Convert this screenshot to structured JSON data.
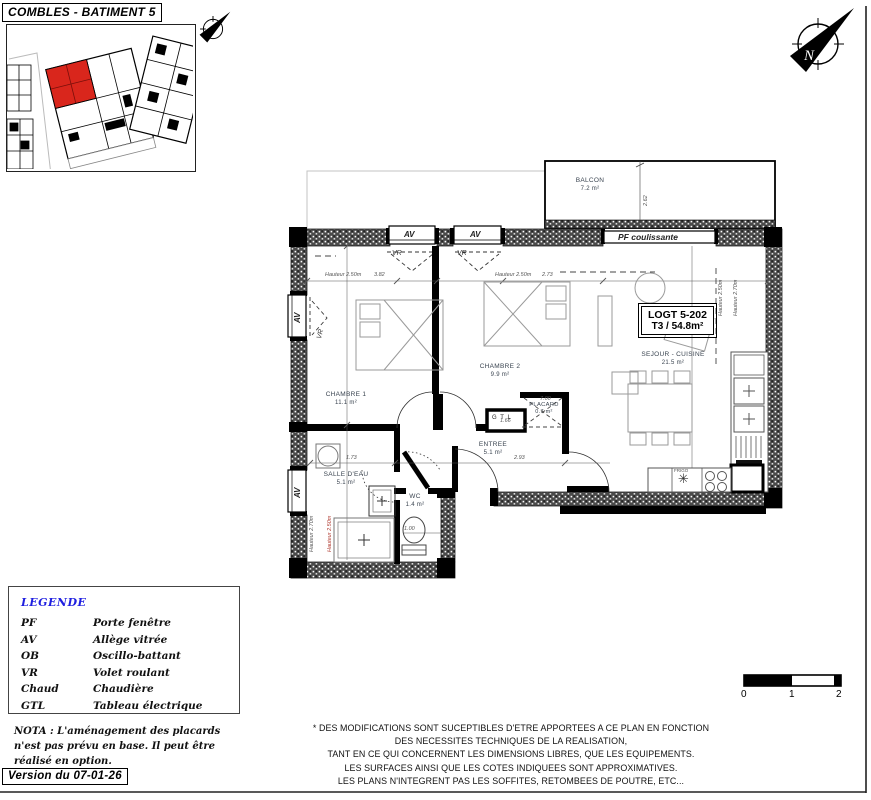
{
  "title": "COMBLES - BATIMENT 5",
  "version_label": "Version du 07-01-26",
  "apartment": {
    "id": "LOGT 5-202",
    "type": "T3 / 54.8m²"
  },
  "rooms": [
    {
      "name": "BALCON",
      "area": "7.2 m²"
    },
    {
      "name": "CHAMBRE 1",
      "area": "11.1 m²"
    },
    {
      "name": "CHAMBRE 2",
      "area": "9.9 m²"
    },
    {
      "name": "SEJOUR - CUISINE",
      "area": "21.5 m²"
    },
    {
      "name": "ENTREE",
      "area": "5.1 m²"
    },
    {
      "name": "SALLE D'EAU",
      "area": "5.1 m²"
    },
    {
      "name": "WC",
      "area": "1.4 m²"
    },
    {
      "name": "PLACARD",
      "area": "0.7 m²"
    }
  ],
  "plan_annotations": {
    "pf_coulissante": "PF coulissante",
    "av": "AV",
    "vr": "VR",
    "gtl": "G T L",
    "frigo": "FRIGO"
  },
  "dims": [
    "Hauteur 2.50m",
    "3.82",
    "Hauteur 2.50m",
    "2.73",
    "1.73",
    "2.93",
    "1.66",
    "7.00",
    "1.00",
    "Hauteur 2.70m",
    "Hauteur 2.50m",
    "Hauteur 2.50m",
    "Hauteur 2.70m",
    "2.62"
  ],
  "legend": {
    "title": "LEGENDE",
    "items": [
      {
        "abbr": "PF",
        "label": "Porte fenêtre"
      },
      {
        "abbr": "AV",
        "label": "Allège vitrée"
      },
      {
        "abbr": "OB",
        "label": "Oscillo-battant"
      },
      {
        "abbr": "VR",
        "label": "Volet roulant"
      },
      {
        "abbr": "Chaud",
        "label": "Chaudière"
      },
      {
        "abbr": "GTL",
        "label": "Tableau électrique"
      }
    ]
  },
  "nota": {
    "line1": "NOTA : L'aménagement des placards",
    "line2": "n'est pas prévu en base. Il peut être",
    "line3": "réalisé en option."
  },
  "disclaimer": {
    "line1": "* DES MODIFICATIONS SONT SUCEPTIBLES D'ETRE APPORTEES A CE PLAN EN FONCTION",
    "line2": "DES NECESSITES TECHNIQUES DE LA REALISATION,",
    "line3": "TANT EN CE QUI CONCERNENT LES DIMENSIONS LIBRES, QUE LES EQUIPEMENTS.",
    "line4": "LES SURFACES AINSI QUE LES COTES INDIQUEES SONT APPROXIMATIVES.",
    "line5": "LES PLANS N'INTEGRENT PAS LES SOFFITES, RETOMBEES DE POUTRE, ETC..."
  },
  "scale_bar": {
    "t0": "0",
    "t1": "1",
    "t2": "2"
  },
  "icons": {
    "snowflake": "✳",
    "north_letter": "N"
  },
  "colors": {
    "highlight_red": "#d9261c",
    "legend_blue": "#1f1fe0",
    "wall_dark": "#4a4a4a"
  }
}
